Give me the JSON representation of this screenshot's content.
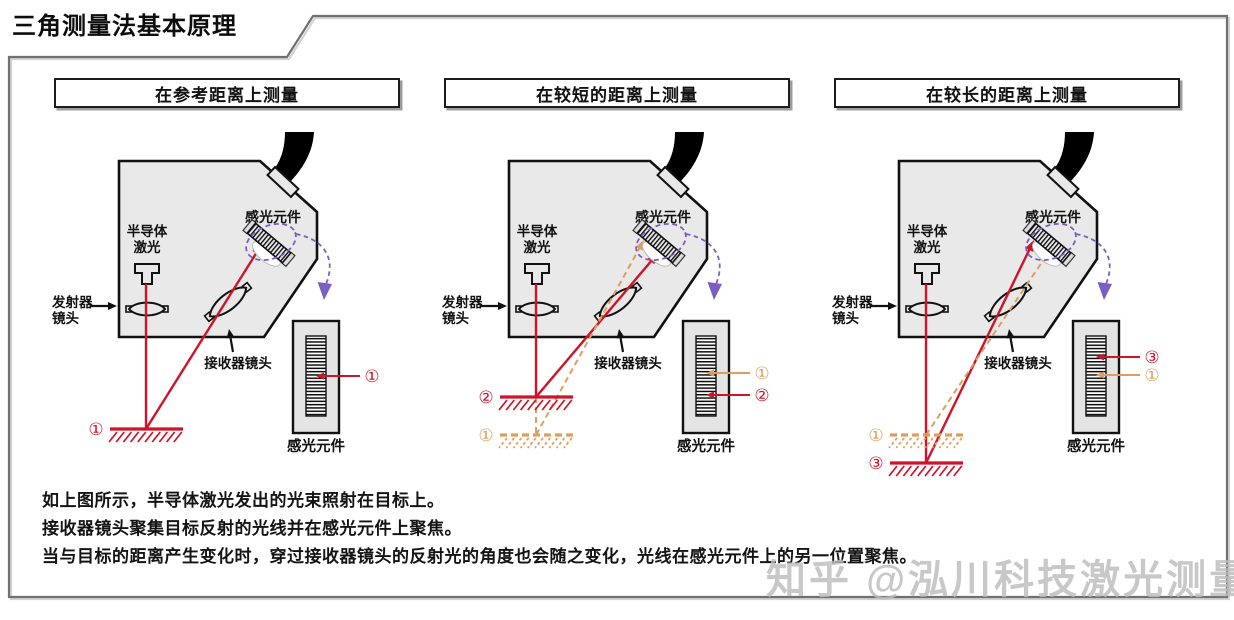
{
  "page": {
    "title": "三角测量法基本原理"
  },
  "watermark": {
    "text": "知乎 @泓川科技激光测量",
    "color": "#bdbdbd"
  },
  "colors": {
    "laser_red": "#cf1328",
    "reference_orange": "#dd9f60",
    "purple": "#7b5ec1",
    "housing_fill": "#e9e9e9",
    "outline": "#111111",
    "frame_gray": "#707070"
  },
  "labels": {
    "photo_element": "感光元件",
    "laser1": "半导体",
    "laser2": "激光",
    "emitter1": "发射器",
    "emitter2": "镜头",
    "receiver": "接收器镜头",
    "detail_caption": "感光元件"
  },
  "panels": [
    {
      "title": "在参考距离上测量",
      "targets": [
        {
          "num": "①",
          "style": "solid",
          "y": 299
        }
      ],
      "solid_target_y": 299,
      "dashed_target_y": null,
      "solid_tip": [
        222,
        114
      ],
      "dashed_tip": null,
      "sensor_pointers": [
        {
          "num": "①",
          "style": "solid",
          "y": 246
        }
      ]
    },
    {
      "title": "在较短的距离上测量",
      "targets": [
        {
          "num": "②",
          "style": "solid",
          "y": 267
        },
        {
          "num": "①",
          "style": "dashed",
          "y": 305
        }
      ],
      "solid_target_y": 267,
      "dashed_target_y": 305,
      "solid_tip": [
        228,
        123
      ],
      "dashed_tip": [
        214,
        110
      ],
      "sensor_pointers": [
        {
          "num": "①",
          "style": "dashed",
          "y": 243
        },
        {
          "num": "②",
          "style": "solid",
          "y": 265
        }
      ]
    },
    {
      "title": "在较长的距离上测量",
      "targets": [
        {
          "num": "①",
          "style": "dashed",
          "y": 305
        },
        {
          "num": "③",
          "style": "solid",
          "y": 333
        }
      ],
      "solid_target_y": 333,
      "dashed_target_y": 305,
      "solid_tip": [
        214,
        110
      ],
      "dashed_tip": [
        228,
        123
      ],
      "sensor_pointers": [
        {
          "num": "③",
          "style": "solid",
          "y": 227
        },
        {
          "num": "①",
          "style": "dashed",
          "y": 245
        }
      ]
    }
  ],
  "description": [
    "如上图所示，半导体激光发出的光束照射在目标上。",
    "接收器镜头聚集目标反射的光线并在感光元件上聚焦。",
    "当与目标的距离产生变化时，穿过接收器镜头的反射光的角度也会随之变化，光线在感光元件上的另一位置聚焦。"
  ]
}
